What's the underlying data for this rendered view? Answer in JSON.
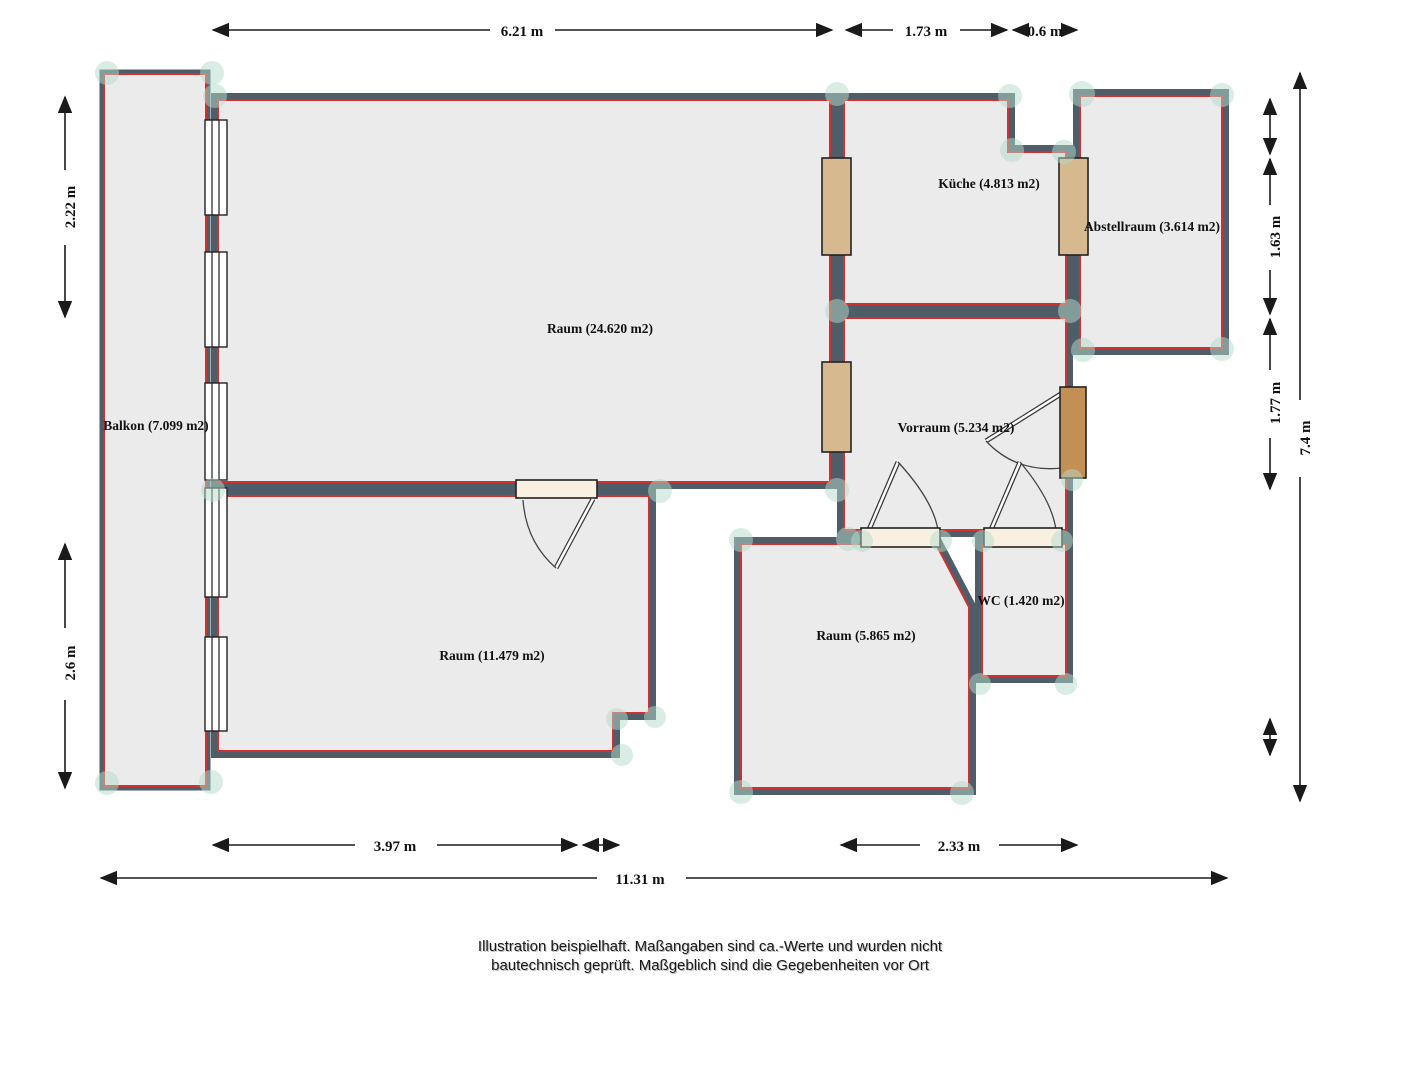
{
  "plan": {
    "rooms": [
      {
        "name": "balkon",
        "label": "Balkon (7.099 m2)"
      },
      {
        "name": "raum-24",
        "label": "Raum (24.620 m2)"
      },
      {
        "name": "kueche",
        "label": "Küche (4.813 m2)"
      },
      {
        "name": "abstellraum",
        "label": "Abstellraum (3.614 m2)"
      },
      {
        "name": "vorraum",
        "label": "Vorraum (5.234 m2)"
      },
      {
        "name": "raum-11",
        "label": "Raum (11.479 m2)"
      },
      {
        "name": "raum-5",
        "label": "Raum (5.865 m2)"
      },
      {
        "name": "wc",
        "label": "WC (1.420 m2)"
      }
    ],
    "dimensions": {
      "top": [
        "6.21 m",
        "1.73 m",
        "0.6 m"
      ],
      "left": [
        "2.22 m",
        "2.6 m"
      ],
      "right": [
        "1.63 m",
        "1.77 m"
      ],
      "right_total": "7.4 m",
      "bottom": [
        "3.97 m",
        "2.33 m"
      ],
      "bottom_total": "11.31 m"
    },
    "footer": {
      "line1": "Illustration beispielhaft. Maßangaben sind ca.-Werte und wurden nicht",
      "line2": "bautechnisch geprüft. Maßgeblich sind die Gegebenheiten vor Ort"
    },
    "colors": {
      "wall": "#4e5d68",
      "accent_red": "#cf3030",
      "room_fill": "#ebebeb",
      "door_tan": "#d6b98e",
      "entry_door": "#c28f55",
      "door_slab": "#faf0e2",
      "corner_dot": "#b5dccb"
    }
  }
}
